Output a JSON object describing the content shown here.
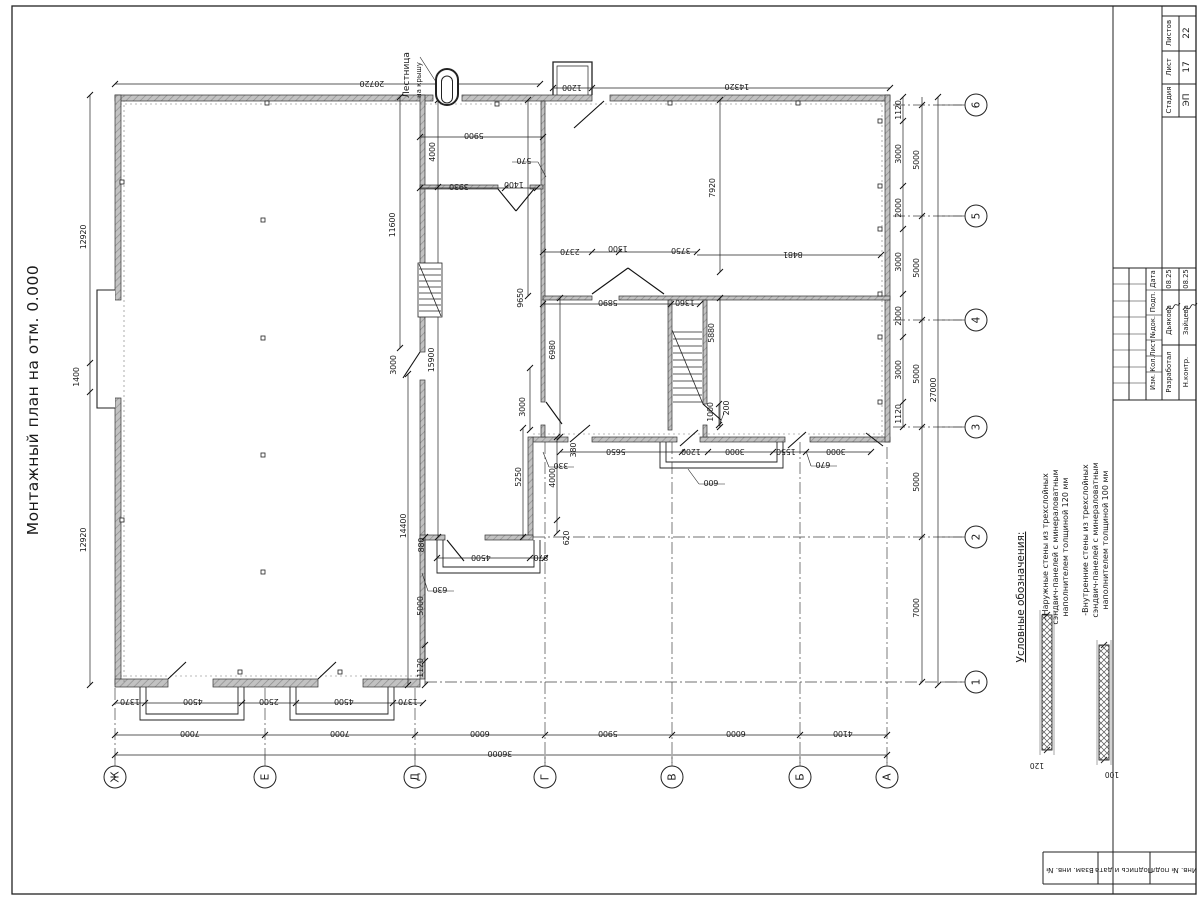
{
  "sheet": {
    "title": "Монтажный план на отм. 0.000"
  },
  "roof_ladder": {
    "line1": "Лестница",
    "line2": "на крышу"
  },
  "legend": {
    "header": "Условные обозначения:",
    "items": [
      {
        "lines": [
          "- Наружные стены из трехслойных",
          "сэндвич-панелей с минераловатным",
          "наполнителем толщиной 120 мм"
        ],
        "dim": "120"
      },
      {
        "lines": [
          "-Внутренние стены из трехслойных",
          "сэндвич-панелей с минераловатным",
          "наполнителем толщиной 100 мм"
        ],
        "dim": "100"
      }
    ]
  },
  "axes": {
    "bottom": [
      {
        "label": "Ж",
        "x": 115
      },
      {
        "label": "Е",
        "x": 265
      },
      {
        "label": "Д",
        "x": 415
      },
      {
        "label": "Г",
        "x": 545
      },
      {
        "label": "В",
        "x": 672
      },
      {
        "label": "Б",
        "x": 800
      },
      {
        "label": "А",
        "x": 887
      }
    ],
    "right": [
      {
        "label": "6",
        "y": 105
      },
      {
        "label": "5",
        "y": 216
      },
      {
        "label": "4",
        "y": 320
      },
      {
        "label": "3",
        "y": 427
      },
      {
        "label": "2",
        "y": 537
      },
      {
        "label": "1",
        "y": 682
      }
    ]
  },
  "dimensions": [
    {
      "t": "20720",
      "x": 372,
      "y": 81,
      "r": 180
    },
    {
      "t": "1200",
      "x": 572,
      "y": 85,
      "r": 180
    },
    {
      "t": "14320",
      "x": 737,
      "y": 84,
      "r": 180
    },
    {
      "t": "5900",
      "x": 474,
      "y": 133,
      "r": 180
    },
    {
      "t": "570",
      "x": 524,
      "y": 158,
      "r": 180
    },
    {
      "t": "3930",
      "x": 459,
      "y": 184,
      "r": 180
    },
    {
      "t": "1400",
      "x": 514,
      "y": 182,
      "r": 180
    },
    {
      "t": "2370",
      "x": 570,
      "y": 249,
      "r": 180
    },
    {
      "t": "1300",
      "x": 618,
      "y": 246,
      "r": 180
    },
    {
      "t": "3750",
      "x": 681,
      "y": 248,
      "r": 180
    },
    {
      "t": "8481",
      "x": 793,
      "y": 252,
      "r": 180
    },
    {
      "t": "5890",
      "x": 608,
      "y": 300,
      "r": 180
    },
    {
      "t": "1360",
      "x": 685,
      "y": 300,
      "r": 180
    },
    {
      "t": "330",
      "x": 561,
      "y": 463,
      "r": 180
    },
    {
      "t": "5650",
      "x": 616,
      "y": 449,
      "r": 180
    },
    {
      "t": "1200",
      "x": 691,
      "y": 449,
      "r": 180
    },
    {
      "t": "3000",
      "x": 735,
      "y": 449,
      "r": 180
    },
    {
      "t": "1550",
      "x": 786,
      "y": 449,
      "r": 180
    },
    {
      "t": "3000",
      "x": 836,
      "y": 449,
      "r": 180
    },
    {
      "t": "670",
      "x": 823,
      "y": 462,
      "r": 180
    },
    {
      "t": "600",
      "x": 711,
      "y": 480,
      "r": 180
    },
    {
      "t": "4500",
      "x": 481,
      "y": 555,
      "r": 180
    },
    {
      "t": "870",
      "x": 541,
      "y": 555,
      "r": 180
    },
    {
      "t": "630",
      "x": 440,
      "y": 587,
      "r": 180
    },
    {
      "t": "1370",
      "x": 130,
      "y": 699,
      "r": 180
    },
    {
      "t": "4500",
      "x": 193,
      "y": 699,
      "r": 180
    },
    {
      "t": "2500",
      "x": 269,
      "y": 699,
      "r": 180
    },
    {
      "t": "4500",
      "x": 344,
      "y": 699,
      "r": 180
    },
    {
      "t": "1370",
      "x": 408,
      "y": 699,
      "r": 180
    },
    {
      "t": "7000",
      "x": 190,
      "y": 731,
      "r": 180
    },
    {
      "t": "7000",
      "x": 340,
      "y": 731,
      "r": 180
    },
    {
      "t": "6000",
      "x": 480,
      "y": 731,
      "r": 180
    },
    {
      "t": "5900",
      "x": 608,
      "y": 731,
      "r": 180
    },
    {
      "t": "6000",
      "x": 736,
      "y": 731,
      "r": 180
    },
    {
      "t": "4100",
      "x": 843,
      "y": 731,
      "r": 180
    },
    {
      "t": "36000",
      "x": 500,
      "y": 751,
      "r": 180
    },
    {
      "t": "12920",
      "x": 86,
      "y": 237,
      "r": -90
    },
    {
      "t": "1400",
      "x": 79,
      "y": 377,
      "r": -90
    },
    {
      "t": "12920",
      "x": 86,
      "y": 540,
      "r": -90
    },
    {
      "t": "4000",
      "x": 435,
      "y": 152,
      "r": -90
    },
    {
      "t": "11600",
      "x": 395,
      "y": 225,
      "r": -90
    },
    {
      "t": "9650",
      "x": 523,
      "y": 298,
      "r": -90
    },
    {
      "t": "7920",
      "x": 715,
      "y": 188,
      "r": -90
    },
    {
      "t": "15900",
      "x": 434,
      "y": 360,
      "r": -90
    },
    {
      "t": "6980",
      "x": 555,
      "y": 350,
      "r": -90
    },
    {
      "t": "5880",
      "x": 714,
      "y": 333,
      "r": -90
    },
    {
      "t": "3000",
      "x": 525,
      "y": 407,
      "r": -90
    },
    {
      "t": "1000",
      "x": 713,
      "y": 412,
      "r": -90
    },
    {
      "t": "200",
      "x": 729,
      "y": 408,
      "r": -90
    },
    {
      "t": "3000",
      "x": 396,
      "y": 365,
      "r": -90
    },
    {
      "t": "380",
      "x": 576,
      "y": 450,
      "r": -90
    },
    {
      "t": "5250",
      "x": 521,
      "y": 477,
      "r": -90
    },
    {
      "t": "4000",
      "x": 555,
      "y": 478,
      "r": -90
    },
    {
      "t": "620",
      "x": 569,
      "y": 538,
      "r": -90
    },
    {
      "t": "880",
      "x": 424,
      "y": 545,
      "r": -90
    },
    {
      "t": "5000",
      "x": 423,
      "y": 606,
      "r": -90
    },
    {
      "t": "1120",
      "x": 423,
      "y": 668,
      "r": -90
    },
    {
      "t": "14400",
      "x": 406,
      "y": 526,
      "r": -90
    },
    {
      "t": "1120",
      "x": 901,
      "y": 110,
      "r": -90
    },
    {
      "t": "3000",
      "x": 901,
      "y": 154,
      "r": -90
    },
    {
      "t": "2000",
      "x": 901,
      "y": 208,
      "r": -90
    },
    {
      "t": "3000",
      "x": 901,
      "y": 262,
      "r": -90
    },
    {
      "t": "2000",
      "x": 901,
      "y": 316,
      "r": -90
    },
    {
      "t": "3000",
      "x": 901,
      "y": 370,
      "r": -90
    },
    {
      "t": "1120",
      "x": 901,
      "y": 414,
      "r": -90
    },
    {
      "t": "5000",
      "x": 919,
      "y": 160,
      "r": -90
    },
    {
      "t": "5000",
      "x": 919,
      "y": 268,
      "r": -90
    },
    {
      "t": "5000",
      "x": 919,
      "y": 374,
      "r": -90
    },
    {
      "t": "5000",
      "x": 919,
      "y": 482,
      "r": -90
    },
    {
      "t": "7000",
      "x": 919,
      "y": 608,
      "r": -90
    },
    {
      "t": "27000",
      "x": 936,
      "y": 390,
      "r": -90
    }
  ],
  "title_block": {
    "stage_label": "Стадия",
    "stage": "ЭП",
    "sheet_label": "Лист",
    "sheet": "17",
    "sheets_label": "Листов",
    "sheets": "22",
    "header_cells": [
      "Дата",
      "Подп.",
      "№док.",
      "Лист",
      "Кол.",
      "Изм."
    ],
    "rows": [
      {
        "role": "Разработал",
        "name": "Дьякова",
        "date": "08.25"
      },
      {
        "role": "Н.контр.",
        "name": "Зайцева",
        "date": "08.25"
      }
    ],
    "side_cells": [
      "Взам. инв. №",
      "Подпись и дата",
      "Инв. № подл."
    ]
  }
}
